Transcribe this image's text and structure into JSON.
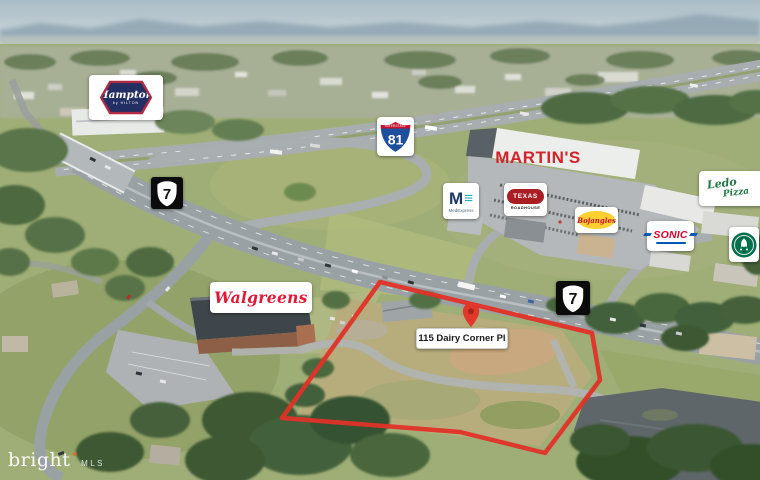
{
  "photo": {
    "watermark": {
      "brand": "bright",
      "mls": "MLS",
      "star_color": "#f26722"
    }
  },
  "property": {
    "address_label": "115 Dairy Corner Pl",
    "outline_color": "#e03228",
    "pin_color": "#e2372b"
  },
  "road_shields": {
    "interstate_81": {
      "caption": "INTERSTATE",
      "number": "81",
      "band_red": "#c8102e",
      "body_blue": "#1d4f9c"
    },
    "route_7_west": {
      "number": "7"
    },
    "route_7_east": {
      "number": "7"
    }
  },
  "businesses": {
    "hampton": {
      "name": "Hampton",
      "tagline": "by HILTON",
      "navy": "#232f63",
      "red": "#b12a43"
    },
    "martins": {
      "name": "MARTIN'S",
      "color": "#d3222a"
    },
    "medexpress": {
      "m": "M",
      "bars": "≡",
      "name": "MedExpress"
    },
    "texas_roadhouse": {
      "line1": "TEXAS",
      "line2": "ROADHOUSE",
      "red": "#a91e22"
    },
    "bojangles": {
      "name": "Bojangles",
      "oval_yellow": "#ffd02e",
      "script_red": "#c8102e"
    },
    "sonic": {
      "name": "SONIC",
      "red": "#e4002b",
      "blue": "#0057b8"
    },
    "ledo_pizza": {
      "line1": "Ledo",
      "line2": "Pizza",
      "green": "#1f7a43"
    },
    "starbucks": {
      "green": "#00704a"
    },
    "walgreens": {
      "name": "Walgreens",
      "color": "#e31837"
    }
  }
}
